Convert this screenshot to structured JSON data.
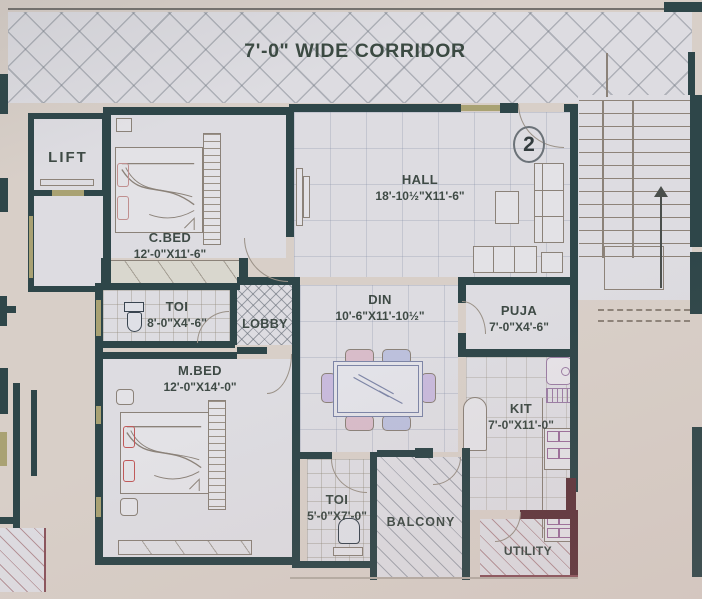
{
  "title": "7'-0\" WIDE CORRIDOR",
  "unit_number": "2",
  "rooms": {
    "lift": {
      "name": "LIFT",
      "dims": ""
    },
    "cbed": {
      "name": "C.BED",
      "dims": "12'-0\"X11'-6\""
    },
    "hall": {
      "name": "HALL",
      "dims": "18'-10½\"X11'-6\""
    },
    "toi1": {
      "name": "TOI",
      "dims": "8'-0\"X4'-6\""
    },
    "lobby": {
      "name": "LOBBY",
      "dims": ""
    },
    "din": {
      "name": "DIN",
      "dims": "10'-6\"X11'-10½\""
    },
    "puja": {
      "name": "PUJA",
      "dims": "7'-0\"X4'-6\""
    },
    "mbed": {
      "name": "M.BED",
      "dims": "12'-0\"X14'-0\""
    },
    "kit": {
      "name": "KIT",
      "dims": "7'-0\"X11'-0\""
    },
    "toi2": {
      "name": "TOI",
      "dims": "5'-0\"X7'-0\""
    },
    "balcony": {
      "name": "BALCONY",
      "dims": ""
    },
    "utility": {
      "name": "UTILITY",
      "dims": ""
    }
  },
  "colors": {
    "paper": "#d8cfc8",
    "floor": "#dddce1",
    "wall": "#2e4649",
    "wall_maroon": "#5e353c",
    "window": "#a9a273",
    "text": "#3e4a45"
  }
}
